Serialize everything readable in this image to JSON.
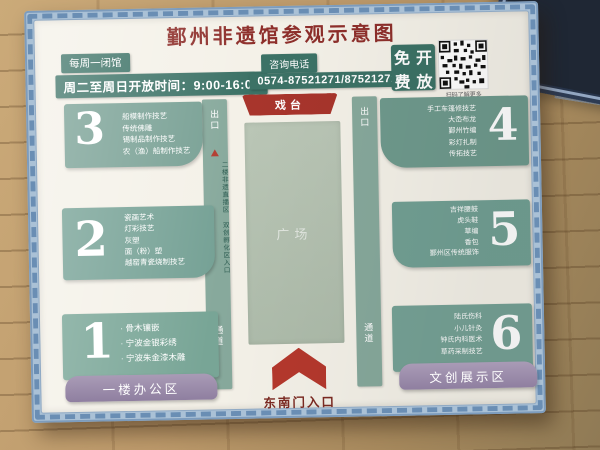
{
  "title": "鄞州非遗馆参观示意图",
  "info": {
    "closed": "每周一闭馆",
    "hours": "周二至周日开放时间：9:00-16:00",
    "phone_label": "咨询电话",
    "phone_number": "0574-87521271/87521272",
    "free_label": "免费开放",
    "free_chars": [
      "免",
      "开",
      "费",
      "放"
    ],
    "qr_caption": "扫码了解更多"
  },
  "map": {
    "stage_label": "戏台",
    "plaza_label": "广场",
    "entrance_label": "东南门入口",
    "left_strip": {
      "exit": "出口",
      "corridor": "通道",
      "note_col_right": "二楼非遗直播区",
      "note_col_left": "双创孵化区入口"
    },
    "right_strip": {
      "exit": "出口",
      "corridor": "通道"
    },
    "zones": [
      {
        "num": "3",
        "items": [
          "船模制作技艺",
          "传统佛雕",
          "锡制品制作技艺",
          "农（渔）船制作技艺"
        ]
      },
      {
        "num": "2",
        "items": [
          "瓷画艺术",
          "灯彩技艺",
          "灰塑",
          "面（粉）塑",
          "越窑青瓷烧制技艺"
        ]
      },
      {
        "num": "1",
        "items": [
          "· 骨木镶嵌",
          "· 宁波金银彩绣",
          "· 宁波朱金漆木雕"
        ]
      },
      {
        "num": "4",
        "items": [
          "手工车篷修技艺",
          "大岙布龙",
          "鄞州竹编",
          "彩灯扎制",
          "传拓技艺"
        ]
      },
      {
        "num": "5",
        "items": [
          "吉祥腰鼓",
          "虎头鞋",
          "草编",
          "香包",
          "鄞州区传统服饰"
        ]
      },
      {
        "num": "6",
        "items": [
          "陆氏伤科",
          "小儿针灸",
          "钟氏内科医术",
          "草药采制技艺"
        ]
      }
    ],
    "area_left": "一楼办公区",
    "area_right": "文创展示区"
  },
  "colors": {
    "teal_dark": "#3c7266",
    "teal_zone": "#7aa093",
    "red_accent": "#a8352c",
    "purple_banner": "#9a8bab",
    "title_red": "#8e2f2b",
    "frame_blue": "#aac1d6"
  }
}
